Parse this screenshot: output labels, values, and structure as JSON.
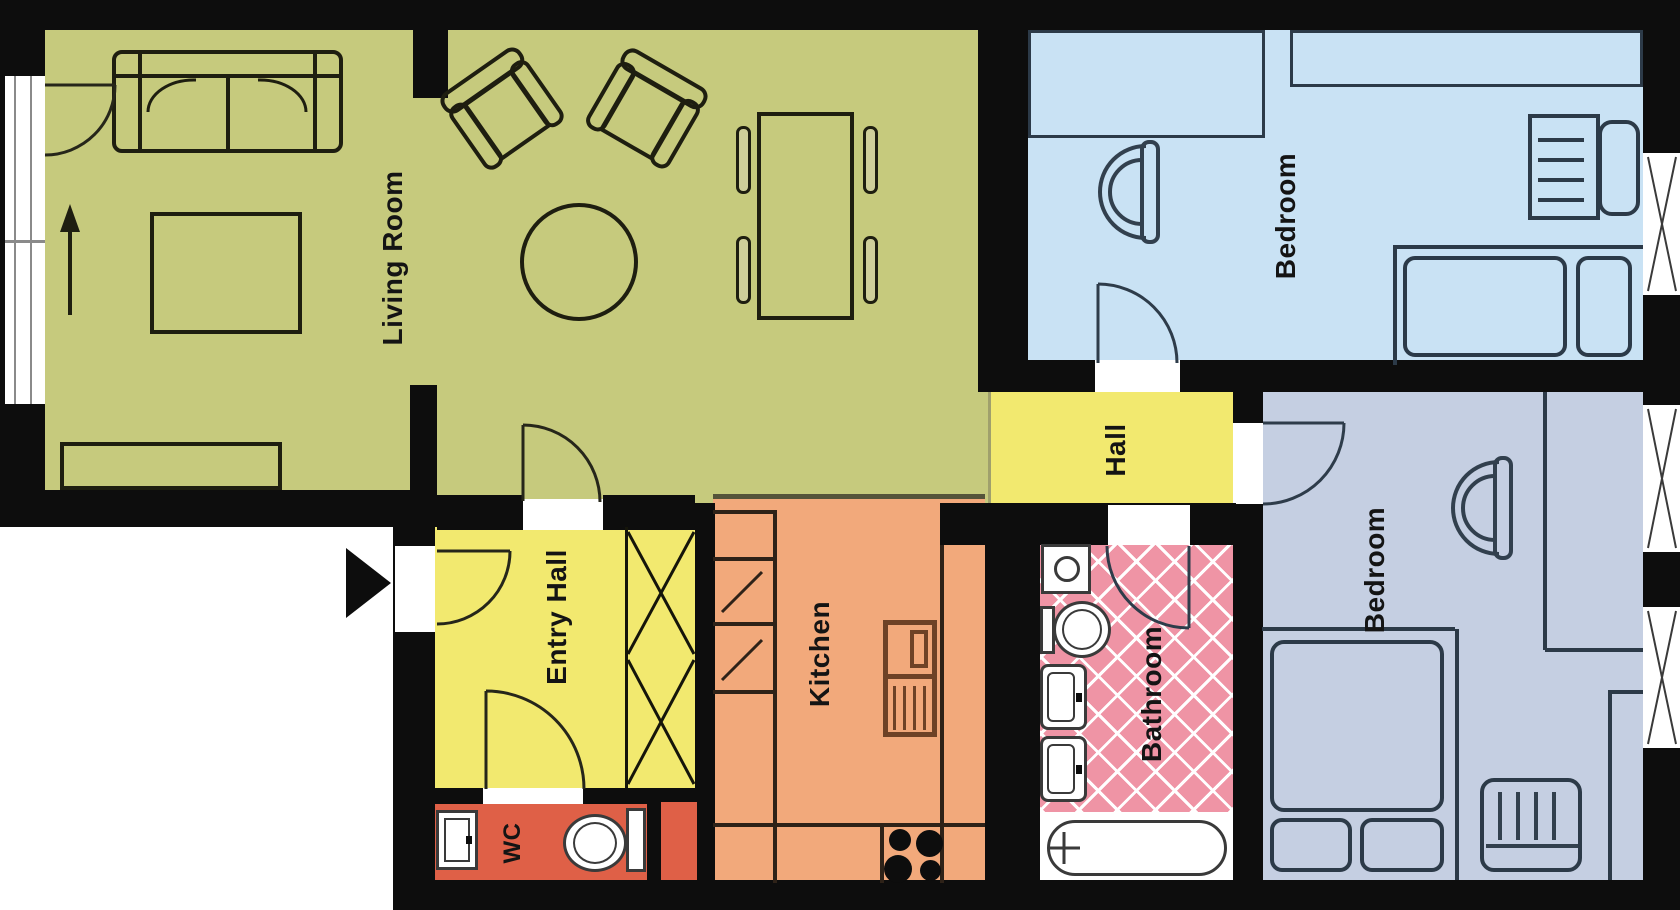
{
  "rooms": {
    "living_room": {
      "label": "Living Room",
      "color": "#c6ca7d",
      "furniture": [
        "sofa",
        "armchair",
        "armchair",
        "round-table",
        "coffee-table",
        "dining-table",
        "dining-chairs",
        "sideboard"
      ]
    },
    "bedroom_top": {
      "label": "Bedroom",
      "color": "#c9e2f4",
      "furniture": [
        "wardrobe",
        "shelf",
        "armchair",
        "desk",
        "desk-chair",
        "single-bed"
      ]
    },
    "bedroom_bottom": {
      "label": "Bedroom",
      "color": "#c5cfe2",
      "furniture": [
        "armchair",
        "double-bed",
        "dresser",
        "closet-niche"
      ]
    },
    "hall": {
      "label": "Hall",
      "color": "#f2e96f"
    },
    "entry_hall": {
      "label": "Entry Hall",
      "color": "#f2e96f",
      "furniture": [
        "closet"
      ]
    },
    "kitchen": {
      "label": "Kitchen",
      "color": "#f2a97b",
      "furniture": [
        "counters",
        "sink-unit",
        "stove"
      ]
    },
    "bathroom": {
      "label": "Bathroom",
      "color": "#ef94a5",
      "furniture": [
        "washing-machine",
        "toilet",
        "sink",
        "sink",
        "bathtub"
      ]
    },
    "wc": {
      "label": "WC",
      "color": "#df6047",
      "furniture": [
        "sink",
        "toilet"
      ]
    }
  },
  "colors": {
    "walls": "#0d0d0d",
    "background": "#ffffff",
    "living_outline": "#1e1e10",
    "bedroom_outline": "#2c3a48",
    "kitchen_unit": "#6e4226",
    "fixture_outline": "#3a3a3a"
  }
}
